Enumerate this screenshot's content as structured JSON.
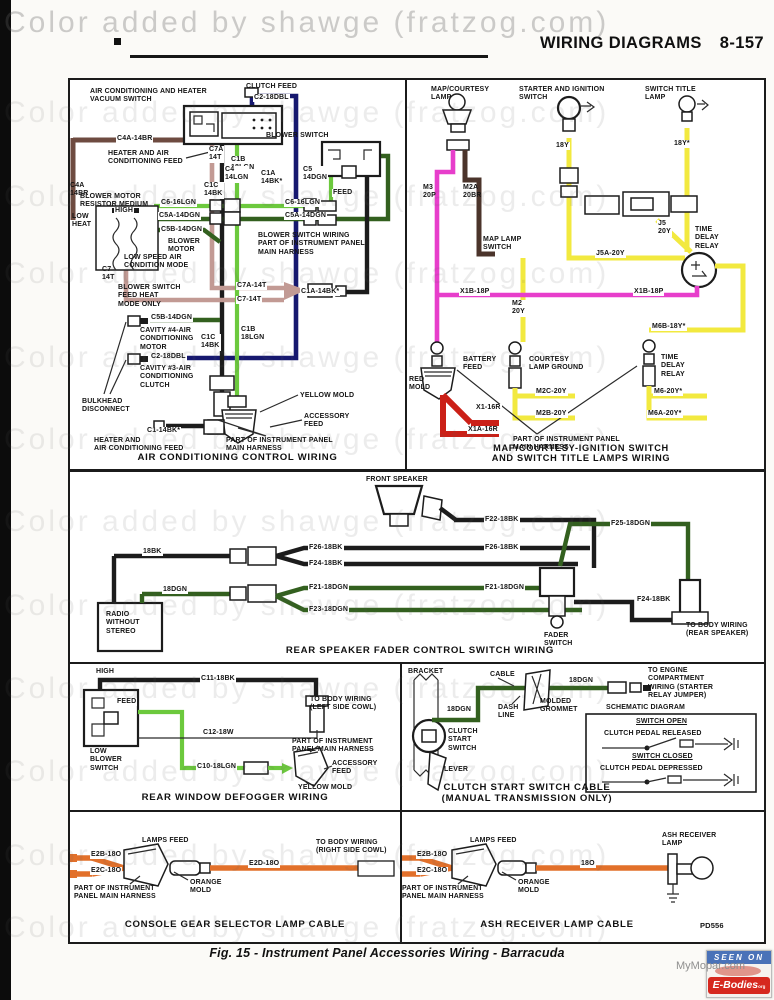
{
  "watermark": {
    "text": "Color added by shawge (fratzog.com)"
  },
  "header": {
    "title": "WIRING DIAGRAMS",
    "page": "8-157"
  },
  "colors": {
    "black_wire": "#1c1c1c",
    "brown_wire": "#6e4b40",
    "tan_wire": "#c29a94",
    "light_green_wire": "#6cc93d",
    "dark_green_wire": "#33601f",
    "dark_blue_wire": "#16186f",
    "pink_wire": "#e73ecb",
    "yellow_wire": "#f2e93f",
    "red_wire": "#cb2017",
    "orange_wire": "#e2702a",
    "dark_brown_wire": "#4b342b"
  },
  "panels": {
    "ac": {
      "title": "AIR CONDITIONING CONTROL WIRING",
      "labels": [
        "AIR CONDITIONING AND HEATER\nVACUUM SWITCH",
        "CLUTCH FEED",
        "C2-18DBL",
        "C4A-14BR",
        "HEATER AND AIR\nCONDITIONING FEED",
        "C7A\n14T",
        "C1B\n18LGN",
        "C1C\n14BK",
        "BLOWER MOTOR\nRESISTOR MEDIUM",
        "C4A\n14BR",
        "HIGH",
        "LOW\nHEAT",
        "C6-16LGN",
        "C6-16LGN",
        "C5A-14DGN",
        "C5A-14DGN",
        "C5B-14DGN",
        "BLOWER\nMOTOR",
        "BLOWER SWITCH",
        "C4\n14LGN",
        "C1A\n14BK*",
        "C5\n14DGN",
        "FEED",
        "BLOWER SWITCH WIRING\nPART OF INSTRUMENT PANEL\nMAIN HARNESS",
        "LOW SPEED AIR\nCONDITION MODE",
        "C7\n14T",
        "BLOWER SWITCH\nFEED HEAT\nMODE ONLY",
        "C7A-14T",
        "C7-14T",
        "C1A-14BK*",
        "C5B-14DGN",
        "CAVITY #4-AIR\nCONDITIONING\nMOTOR",
        "C1C\n14BK",
        "C1B\n18LGN",
        "C2-18DBL",
        "CAVITY #3-AIR\nCONDITIONING\nCLUTCH",
        "BULKHEAD\nDISCONNECT",
        "YELLOW MOLD",
        "ACCESSORY\nFEED",
        "C1-14BK*",
        "HEATER AND\nAIR CONDITIONING FEED",
        "PART OF INSTRUMENT PANEL\nMAIN HARNESS"
      ]
    },
    "map": {
      "title": "MAP/COURTESY-IGNITION SWITCH\nAND SWITCH TITLE LAMPS WIRING",
      "labels": [
        "MAP/COURTESY\nLAMP",
        "STARTER AND IGNITION\nSWITCH",
        "SWITCH TITLE\nLAMP",
        "18Y",
        "18Y*",
        "M3\n20P",
        "M2A\n20BR",
        "MAP LAMP\nSWITCH",
        "J5\n20Y",
        "TIME\nDELAY\nRELAY",
        "J5A-20Y",
        "X1B-18P",
        "X1B-18P",
        "M2\n20Y",
        "M6B-18Y*",
        "BATTERY\nFEED",
        "RED\nMOLD",
        "X1-16R",
        "X1A-16R",
        "COURTESY\nLAMP GROUND",
        "M2C-20Y",
        "M2B-20Y",
        "TIME\nDELAY\nRELAY",
        "M6-20Y*",
        "M6A-20Y*",
        "PART OF INSTRUMENT PANEL\nMAIN HARNESS"
      ]
    },
    "fader": {
      "title": "REAR SPEAKER FADER CONTROL SWITCH WIRING",
      "labels": [
        "FRONT SPEAKER",
        "18BK",
        "18DGN",
        "F26-18BK",
        "F24-18BK",
        "F21-18DGN",
        "F23-18DGN",
        "RADIO\nWITHOUT\nSTEREO",
        "F22-18BK",
        "F26-18BK",
        "F21-18DGN",
        "F25-18DGN",
        "F24-18BK",
        "TO BODY WIRING\n(REAR SPEAKER)",
        "FADER\nSWITCH"
      ]
    },
    "defogger": {
      "title": "REAR WINDOW DEFOGGER WIRING",
      "labels": [
        "HIGH",
        "C11-18BK",
        "TO BODY WIRING\n(LEFT SIDE COWL)",
        "FEED",
        "LOW\nBLOWER\nSWITCH",
        "C12-18W",
        "C10-18LGN",
        "PART OF INSTRUMENT\nPANEL MAIN HARNESS",
        "ACCESSORY\nFEED",
        "YELLOW MOLD"
      ]
    },
    "clutch": {
      "title": "CLUTCH START SWITCH CABLE\n(MANUAL TRANSMISSION ONLY)",
      "labels": [
        "BRACKET",
        "CABLE",
        "18DGN",
        "TO ENGINE\nCOMPARTMENT\nWIRING (STARTER\nRELAY JUMPER)",
        "DASH\nLINE",
        "MOLDED\nGROMMET",
        "18DGN",
        "CLUTCH\nSTART\nSWITCH",
        "LEVER",
        "SCHEMATIC DIAGRAM",
        "SWITCH OPEN",
        "CLUTCH PEDAL RELEASED",
        "SWITCH CLOSED",
        "CLUTCH PEDAL DEPRESSED"
      ]
    },
    "console": {
      "title": "CONSOLE GEAR SELECTOR LAMP CABLE",
      "labels": [
        "LAMPS FEED",
        "E2B-18O",
        "E2C-18O",
        "PART OF INSTRUMENT\nPANEL MAIN HARNESS",
        "ORANGE\nMOLD",
        "E2D-18O",
        "TO BODY WIRING\n(RIGHT SIDE COWL)"
      ]
    },
    "ash": {
      "title": "ASH RECEIVER LAMP CABLE",
      "part_code": "PD556",
      "labels": [
        "LAMPS FEED",
        "E2B-18O",
        "E2C-18O",
        "PART OF INSTRUMENT\nPANEL MAIN HARNESS",
        "ORANGE\nMOLD",
        "18O",
        "ASH RECEIVER\nLAMP"
      ]
    }
  },
  "caption": "Fig. 15 - Instrument Panel Accessories Wiring -  Barracuda",
  "badge": {
    "seen_on": "SEEN ON",
    "brand": "E-Bodies",
    "brand_suffix": "org",
    "site": "MyMopar.com"
  }
}
